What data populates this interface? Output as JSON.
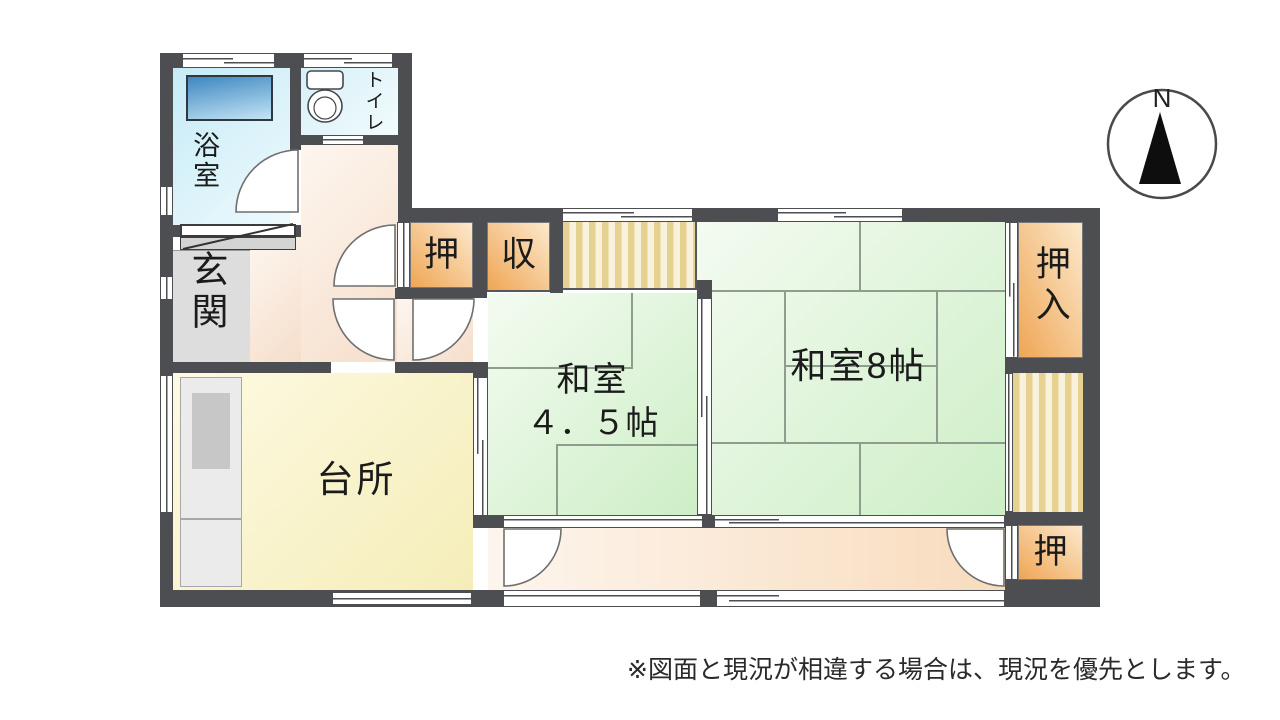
{
  "floorplan": {
    "rooms": {
      "bathroom": "浴室",
      "toilet": "トイレ",
      "entrance": "玄関",
      "kitchen": "台所",
      "washitsu_small_name": "和室",
      "washitsu_small_size": "４．５帖",
      "washitsu_large": "和室8帖",
      "closet_hall": "押",
      "closet_shu": "収",
      "oshiire": "押入",
      "closet_south": "押"
    },
    "compass_north": "N",
    "disclaimer": "※図面と現況が相違する場合は、現況を優先とします。"
  },
  "palette": {
    "wall": "#4c4e52",
    "line": "#8f9e8c",
    "text": "#1b1b1b",
    "tatami1": "#f4fbf1",
    "tatami2": "#cdeec6",
    "closet1": "#fce9cd",
    "closet2": "#efa655",
    "stripe1": "#f8f2dc",
    "stripe2": "#e5d190",
    "bath1": "#c6ebf6",
    "bath2": "#eefafd",
    "toilet-floor": "#d6f0f8",
    "tub1": "#3f87c0",
    "tub2": "#c2e4f5",
    "hall1": "#fdf6ef",
    "hall2": "#f6decb",
    "kitchen1": "#fdfae3",
    "kitchen2": "#f5edb8",
    "corridor1": "#fdf5ed",
    "corridor2": "#f8dcbd",
    "genkan": "#dddddd",
    "counter": "#ebebeb",
    "counter-dark": "#c7c7c7"
  }
}
